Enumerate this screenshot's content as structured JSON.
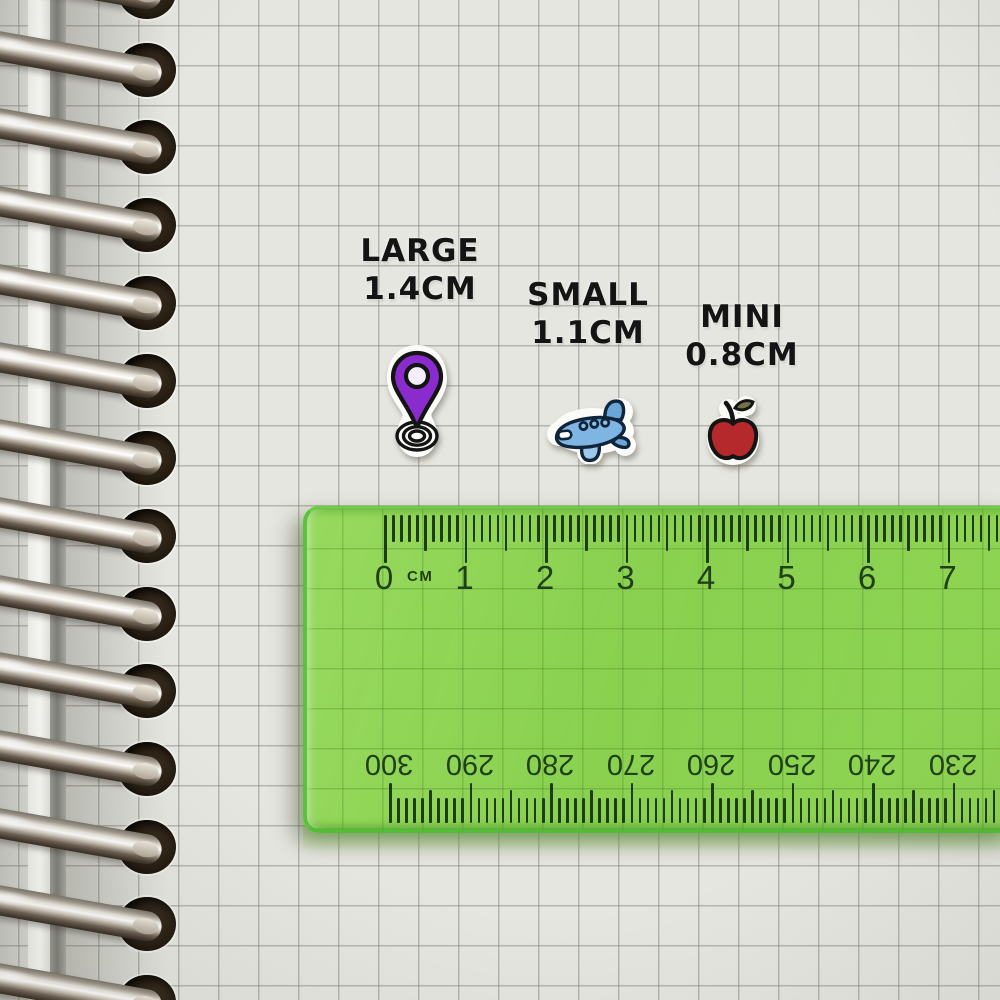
{
  "stickers": {
    "large": {
      "label": "LARGE",
      "size": "1.4CM",
      "icon": "location-pin",
      "color": "#8a2bce"
    },
    "small": {
      "label": "SMALL",
      "size": "1.1CM",
      "icon": "airplane",
      "color": "#7fb5e3"
    },
    "mini": {
      "label": "MINI",
      "size": "0.8CM",
      "icon": "apple",
      "color": "#b5282b"
    }
  },
  "ruler": {
    "unit_label": "CM",
    "top_numbers": [
      "0",
      "1",
      "2",
      "3",
      "4",
      "5",
      "6",
      "7"
    ],
    "bottom_numbers": [
      "300",
      "290",
      "280",
      "270",
      "260",
      "250",
      "240",
      "230"
    ],
    "colors": {
      "body_green": "#86d14c",
      "edge_green": "#56c437",
      "marking": "#1d3d18"
    }
  },
  "notebook": {
    "paper_color": "#e6e6e1",
    "grid_color": "#b5b5b0",
    "binding": "metal-spiral-rings"
  },
  "label_text_color": "#141414"
}
